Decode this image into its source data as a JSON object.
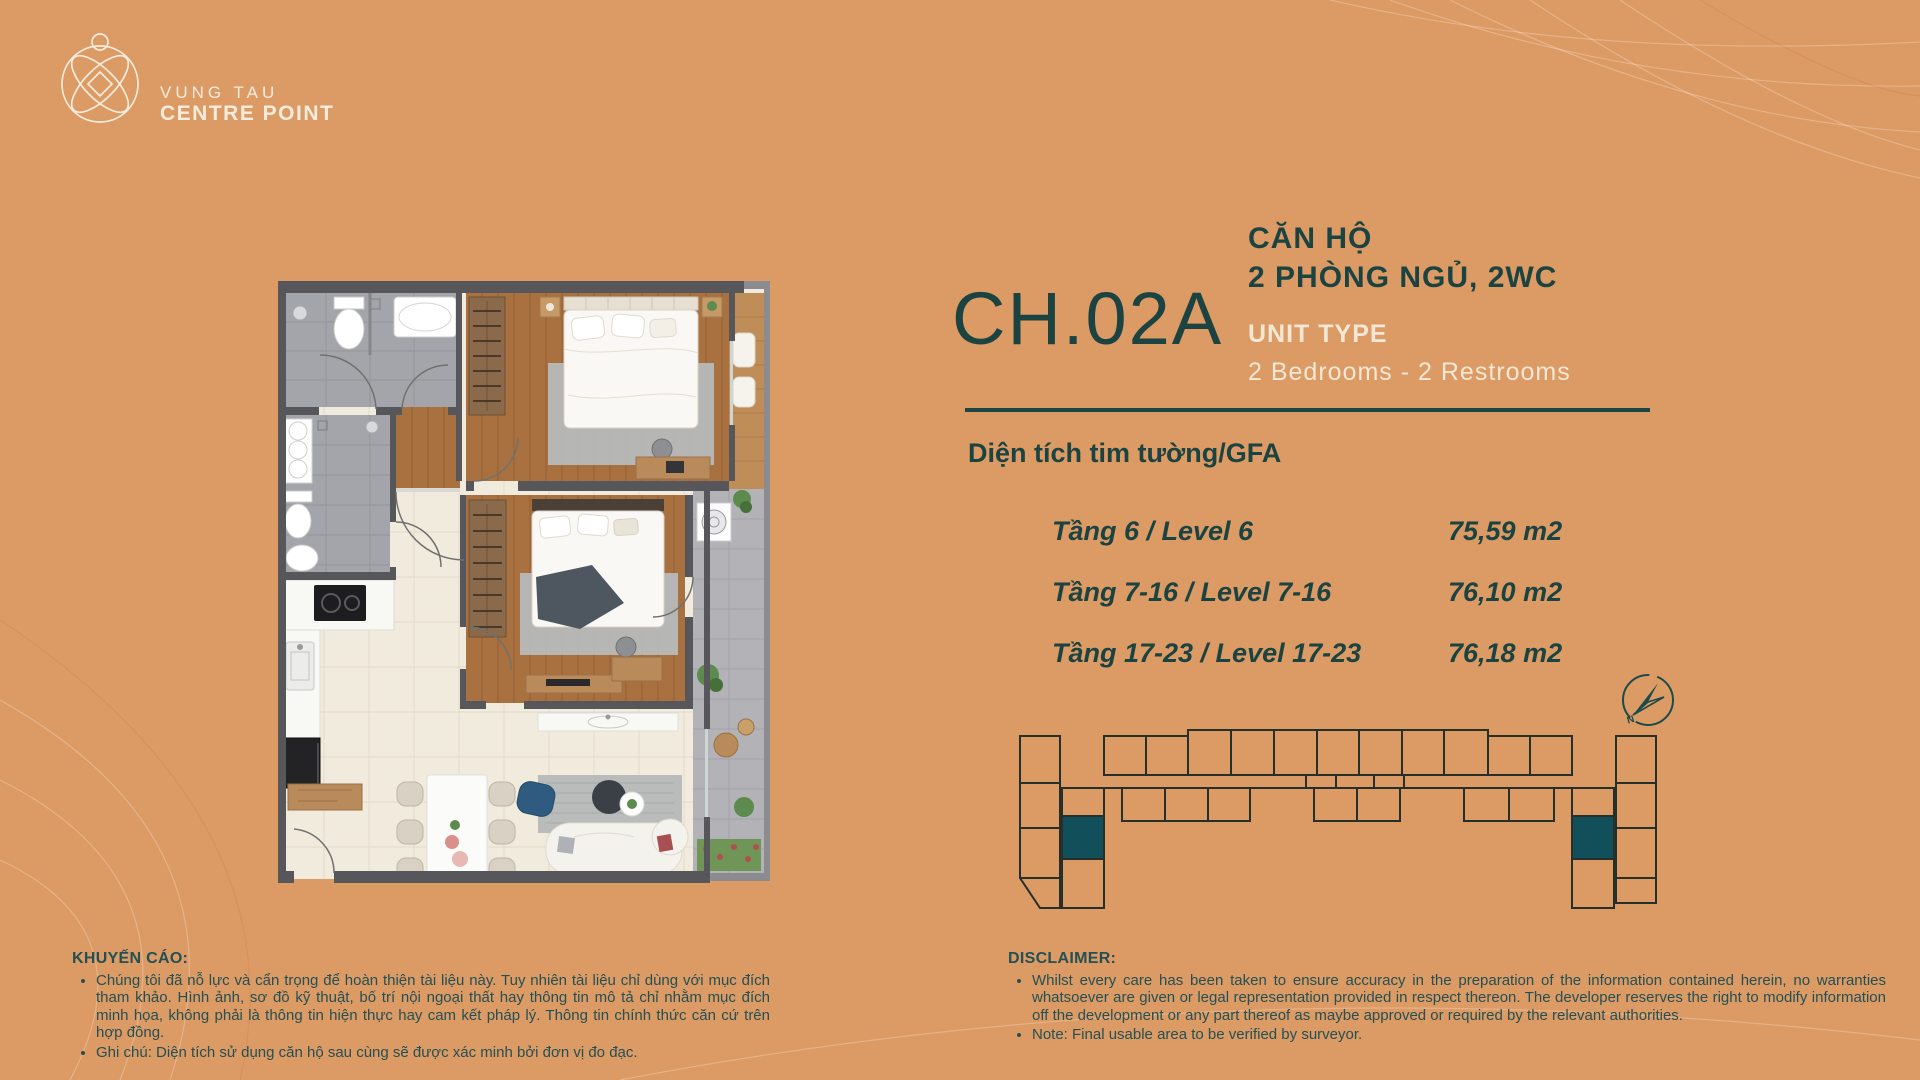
{
  "logo": {
    "name_top": "VUNG TAU",
    "name_bottom": "CENTRE POINT"
  },
  "unit": {
    "code": "CH.02A",
    "category_vi": "CĂN HỘ",
    "bedrooms_vi": "2 PHÒNG NGỦ, 2WC",
    "unit_type_label": "UNIT TYPE",
    "unit_type_value": "2 Bedrooms - 2 Restrooms"
  },
  "area_table": {
    "heading": "Diện tích tim tường/GFA",
    "rows": [
      {
        "label": "Tầng 6 / Level 6",
        "value": "75,59 m2"
      },
      {
        "label": "Tầng 7-16 / Level 7-16",
        "value": "76,10 m2"
      },
      {
        "label": "Tầng 17-23 / Level 17-23",
        "value": "76,18 m2"
      }
    ]
  },
  "compass": {
    "north_label": "N"
  },
  "advisory": {
    "heading": "KHUYẾN CÁO:",
    "bullet_1": "Chúng tôi đã nỗ lực và cẩn trọng để hoàn thiện tài liệu này. Tuy nhiên tài liệu chỉ dùng với mục đích tham khảo. Hình ảnh, sơ đồ kỹ thuật, bố trí nội ngoại thất hay thông tin mô tả chỉ nhằm mục đích minh họa, không phải là thông tin hiện thực hay cam kết pháp lý. Thông tin chính thức căn cứ trên hợp đồng.",
    "bullet_2": "Ghi chú: Diện tích sử dụng căn hộ sau cùng sẽ được xác minh bởi đơn vị đo đạc."
  },
  "disclaimer": {
    "heading": "DISCLAIMER:",
    "bullet_1": "Whilst every care has been taken to ensure accuracy in the preparation of the information contained herein, no warranties whatsoever are given or legal representation provided in respect thereon. The developer reserves the right to modify information off the development or any part thereof as maybe approved or required by the relevant authorities.",
    "bullet_2": "Note: Final usable area to be verified by surveyor."
  },
  "colors": {
    "background": "#DC9A64",
    "teal_dark": "#1B4341",
    "cream_text": "#F3E7D5",
    "footprint_highlight": "#11505A",
    "wall_gray": "#57565A"
  }
}
